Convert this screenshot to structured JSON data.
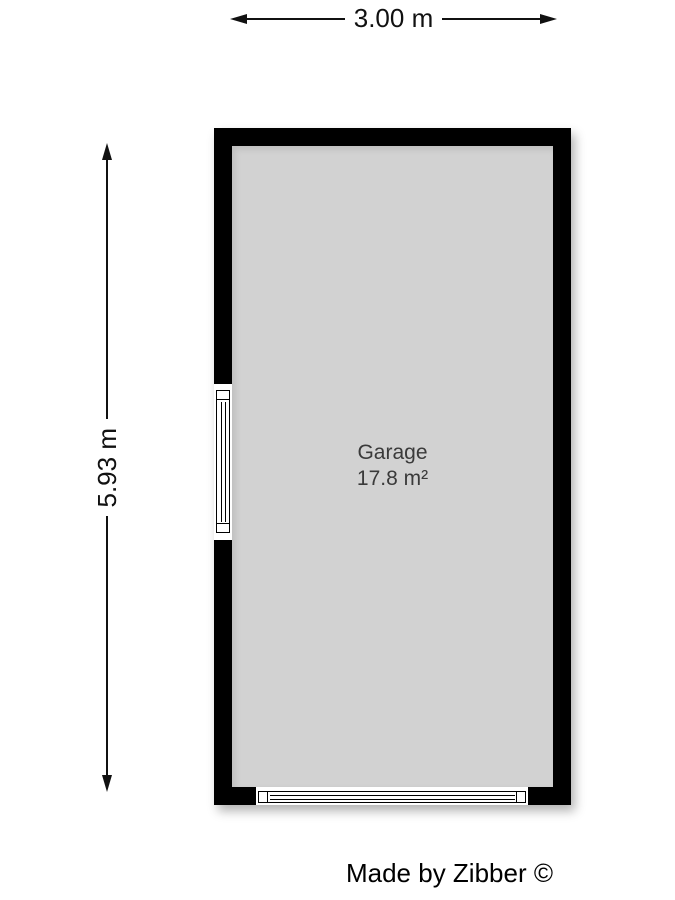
{
  "dimensions": {
    "width_label": "3.00 m",
    "height_label": "5.93 m"
  },
  "room": {
    "name": "Garage",
    "area": "17.8 m²"
  },
  "footer": {
    "credit": "Made by Zibber ©"
  },
  "colors": {
    "wall": "#000000",
    "floor": "#d2d2d2",
    "opening": "#ffffff",
    "room_text": "#3a3a3a",
    "dim_text": "#111111"
  }
}
